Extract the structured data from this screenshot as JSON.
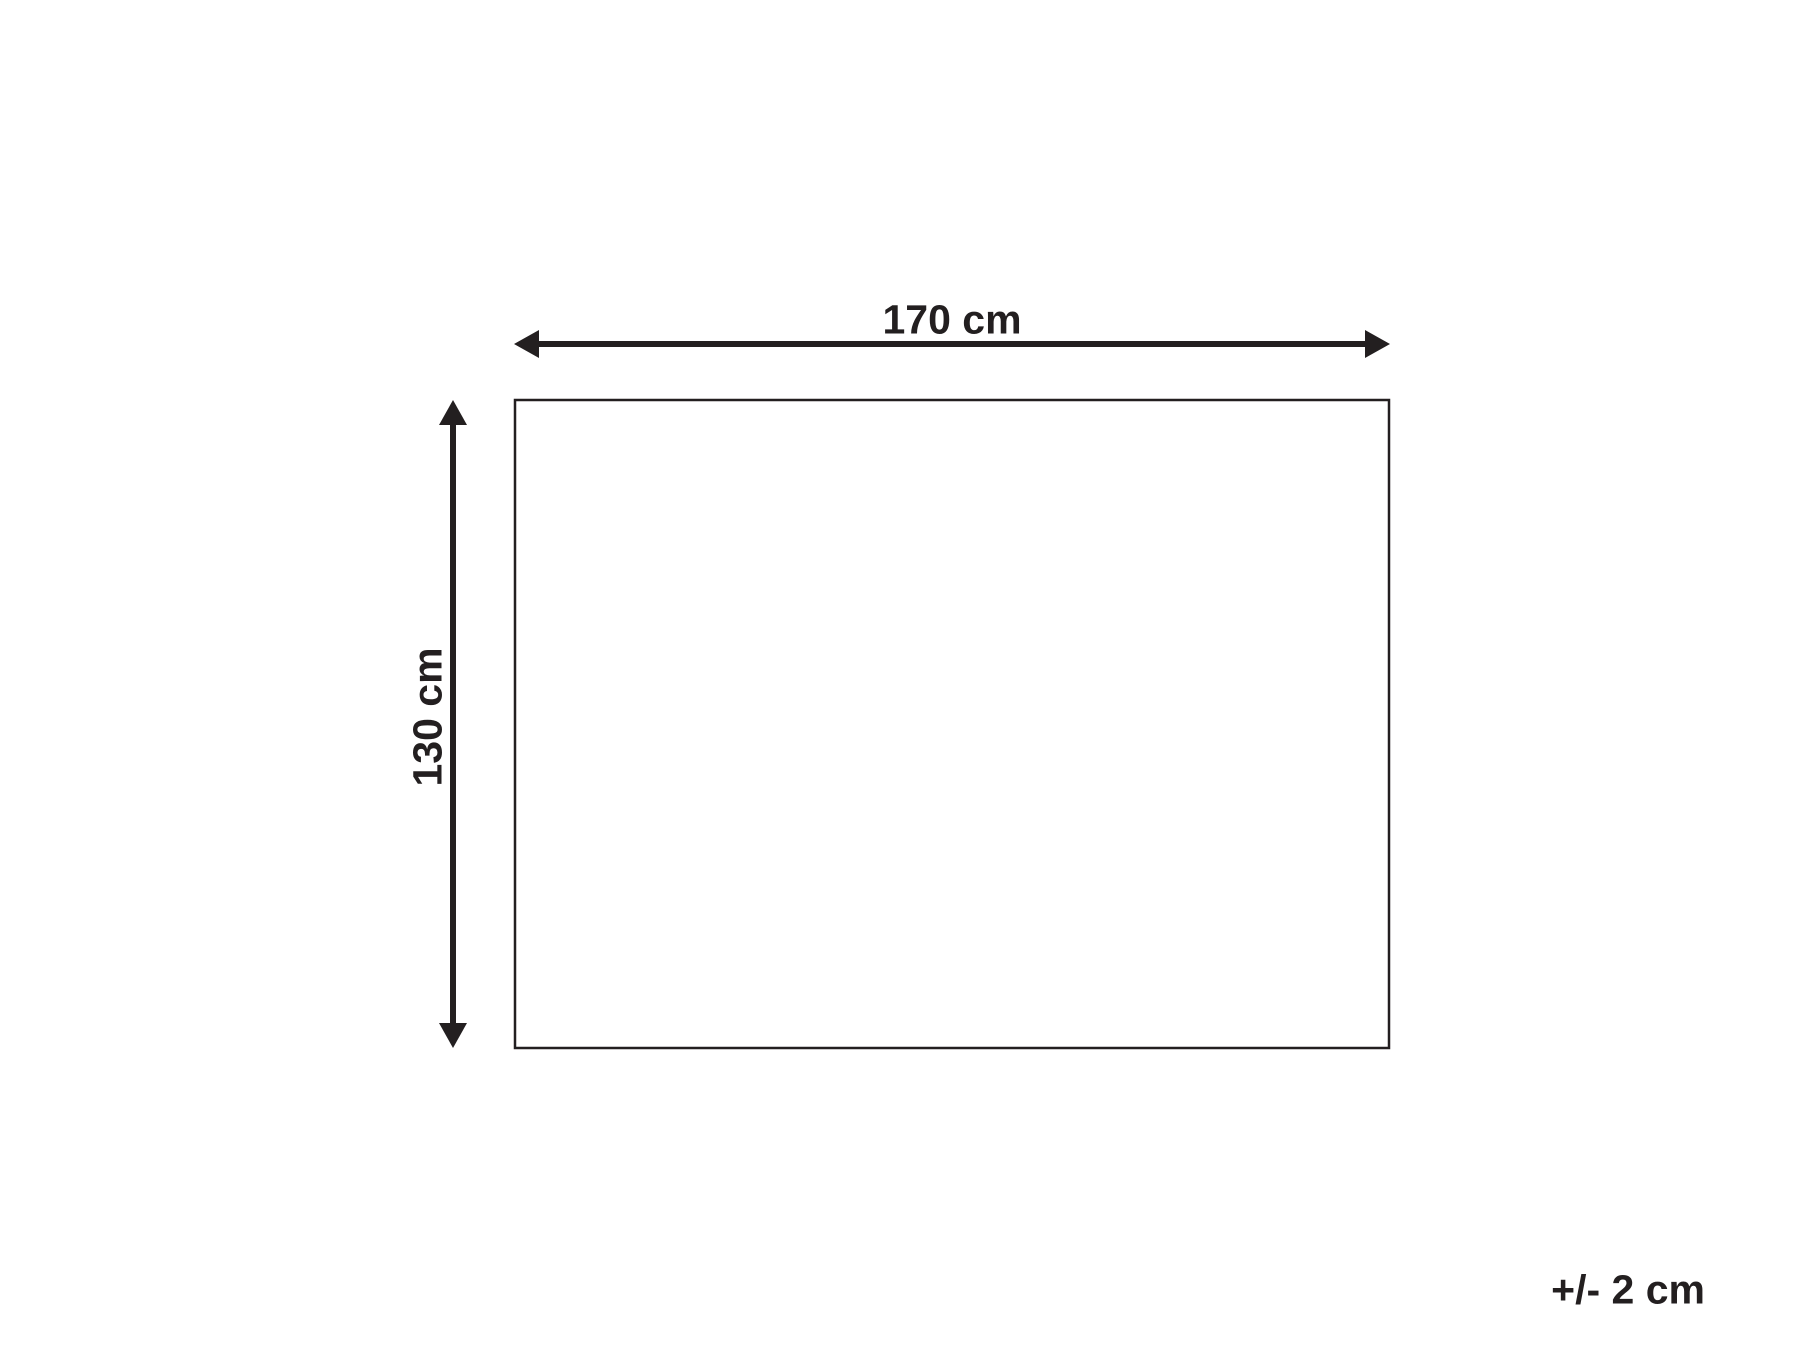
{
  "diagram": {
    "type": "product-dimension-diagram",
    "width_label": "170 cm",
    "height_label": "130 cm",
    "tolerance_label": "+/- 2 cm",
    "width_cm": 170,
    "height_cm": 130,
    "tolerance_cm": 2,
    "unit": "cm",
    "ink_color": "#231f20",
    "background_color": "#ffffff"
  }
}
